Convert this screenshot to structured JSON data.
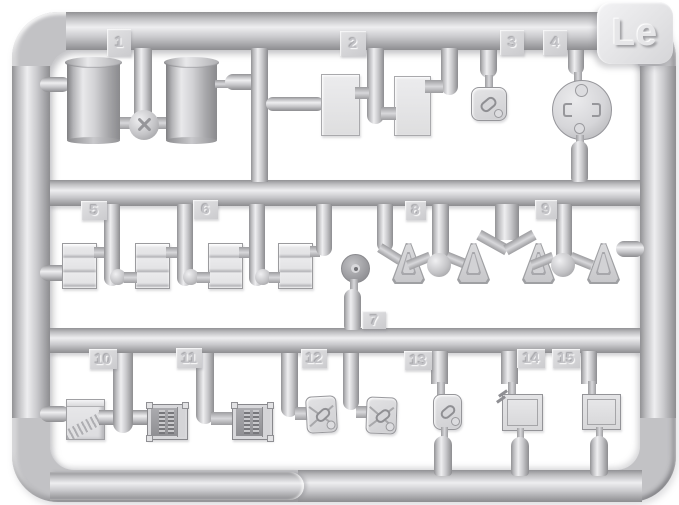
{
  "sprue": {
    "code_label": "Le",
    "parts": [
      {
        "number": "1",
        "shape": "fuel-drum-pair"
      },
      {
        "number": "2",
        "shape": "flat-panel-pair"
      },
      {
        "number": "3",
        "shape": "small-latched-box"
      },
      {
        "number": "4",
        "shape": "round-hatch-disc"
      },
      {
        "number": "5",
        "shape": "slatted-crate"
      },
      {
        "number": "6",
        "shape": "slatted-crate"
      },
      {
        "number": "7",
        "shape": "wheel-hub-disc"
      },
      {
        "number": "8",
        "shape": "triangular-wedge"
      },
      {
        "number": "9",
        "shape": "triangular-wedge"
      },
      {
        "number": "10",
        "shape": "strapped-box"
      },
      {
        "number": "11",
        "shape": "ribbed-radio-box"
      },
      {
        "number": "12",
        "shape": "jerry-can"
      },
      {
        "number": "13",
        "shape": "small-latched-box"
      },
      {
        "number": "14",
        "shape": "hinged-hatch-panel"
      },
      {
        "number": "15",
        "shape": "hatch-panel"
      }
    ]
  },
  "colors": {
    "background": "#ffffff",
    "plastic_highlight": "#efeff1",
    "plastic_mid": "#c6c6c9",
    "plastic_shadow": "#8f8f92"
  }
}
